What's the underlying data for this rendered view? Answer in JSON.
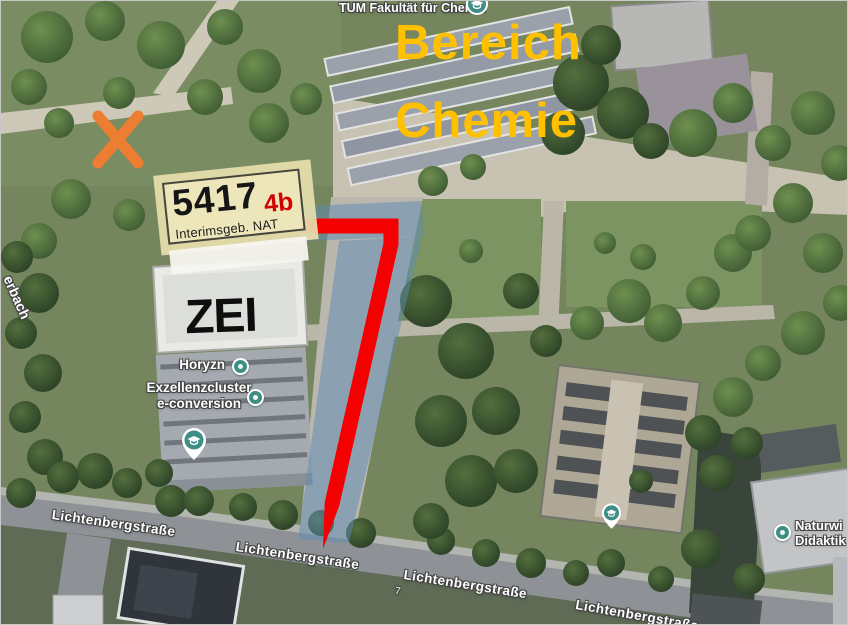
{
  "annotations": {
    "tum_label": "TUM Fakultät für Chemie",
    "area_label": {
      "line1": "Bereich",
      "line2": "Chemie"
    },
    "building_card": {
      "number": "5417",
      "suffix": "4b",
      "name": "Interimsgeb. NAT"
    },
    "zei_label": "ZEI",
    "poi": {
      "horyzn": "Horyzn",
      "cluster_line1": "Exzellenzcluster",
      "cluster_line2": "e-conversion",
      "naturwi_line1": "Naturwi",
      "naturwi_line2": "Didaktik"
    },
    "stream_label": "erbach",
    "house_number": "7"
  },
  "streets": [
    {
      "label": "Lichtenbergstraße"
    },
    {
      "label": "Lichtenbergstraße"
    },
    {
      "label": "Lichtenbergstraße"
    },
    {
      "label": "Lichtenbergstraße"
    }
  ],
  "colors": {
    "area_label": "#FFC000",
    "route": "#F40000",
    "corridor": "#5E8CB4",
    "corridor_edge": "#3E6E9E",
    "x_marker": "#ED7D31",
    "pin": "#3E8E85",
    "card_bg": "#EDE6BA",
    "card_suffix": "#D40000"
  }
}
